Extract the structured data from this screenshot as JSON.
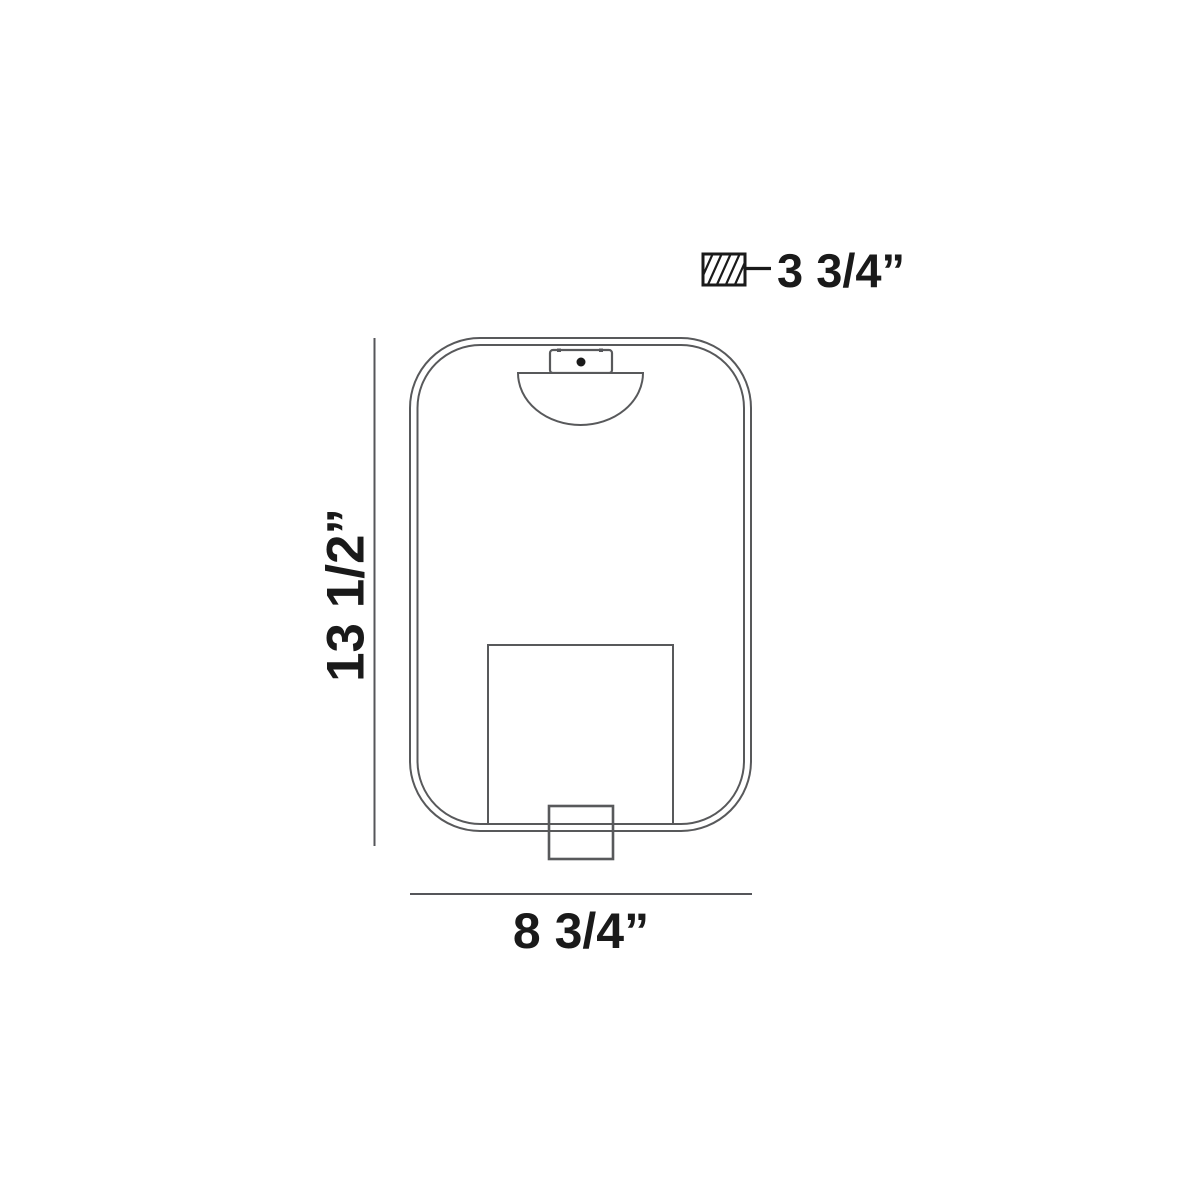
{
  "diagram": {
    "labels": {
      "height": "13 1/2”",
      "width": "8 3/4”",
      "depth": "3 3/4”"
    },
    "colors": {
      "outline": "#58595b",
      "dimension_line": "#55565a",
      "text": "#1a1a1a",
      "background": "#ffffff"
    }
  }
}
